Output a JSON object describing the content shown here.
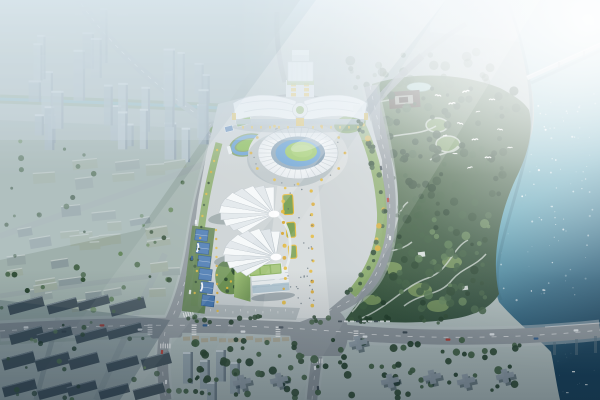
{
  "image": {
    "width": 600,
    "height": 400,
    "kind": "aerial-architectural-rendering"
  },
  "palette": {
    "base": "#aebcbb",
    "haze": "#e0ecf3",
    "city_far": "#b6c4ca",
    "city_mid_overlay": "#8fa39e",
    "slab_dark": "#46565f",
    "slab_top": "#7b8a93",
    "tower_light": "#97a7af",
    "tree_darkest": "#24402c",
    "tree_dark": "#2e4a33",
    "tree_mid": "#3f5e42",
    "tree_light": "#567a52",
    "tree_bright": "#63855a",
    "lawn": "#7fa45c",
    "lawn_bright": "#85b954",
    "pitch_green": "#93c35f",
    "track_blue": "#5f9bd0",
    "stands_blue": "#87a1b5",
    "court_blue": "#4a7ab2",
    "court_edge": "#2f5a8c",
    "court_green": "#5d7f4e",
    "plaza": "#c9d0d2",
    "axis_paving": "#d6dbdc",
    "road": "#8d969c",
    "sidewalk": "#b9c2c6",
    "roof_white": "#f5f8f9",
    "roof_shade": "#e0e6ea",
    "roof_ridge": "#b9c2c8",
    "accent_yellow": "#e3ba3e",
    "accent_yellow_deep": "#d9a832",
    "river_light": "#d3e9ea",
    "river_mid": "#6fb0bf",
    "river_deep": "#1d4a63",
    "bridge_deck": "#d4dcde",
    "temple_roof": "#4a4038",
    "temple_court": "#9a9d92",
    "green_roof": "#8db463",
    "green_roof_panel": "#a9c87e",
    "glass_blue": "#9db8c8",
    "shadow_blue": "#22384a",
    "car_white": "#e8ecef",
    "car_dark": "#3a4750",
    "car_red": "#b23a32",
    "car_blue": "#2c5a8c",
    "warm_row": "#ad9770",
    "white": "#ffffff"
  },
  "scene": {
    "type": "aerial-architectural-rendering",
    "landmarks": [
      "main-stadium",
      "butterfly-roof-exhibition-hall",
      "fan-shaped-arenas",
      "outdoor-court-strip",
      "training-track",
      "green-roof-office-building",
      "riverside-forest-park",
      "temple-courtyard",
      "park-pond",
      "river",
      "upper-bridge",
      "road-bridge",
      "city-district",
      "main-road-intersections",
      "roundabouts",
      "flying-birds",
      "sun-glare"
    ]
  }
}
